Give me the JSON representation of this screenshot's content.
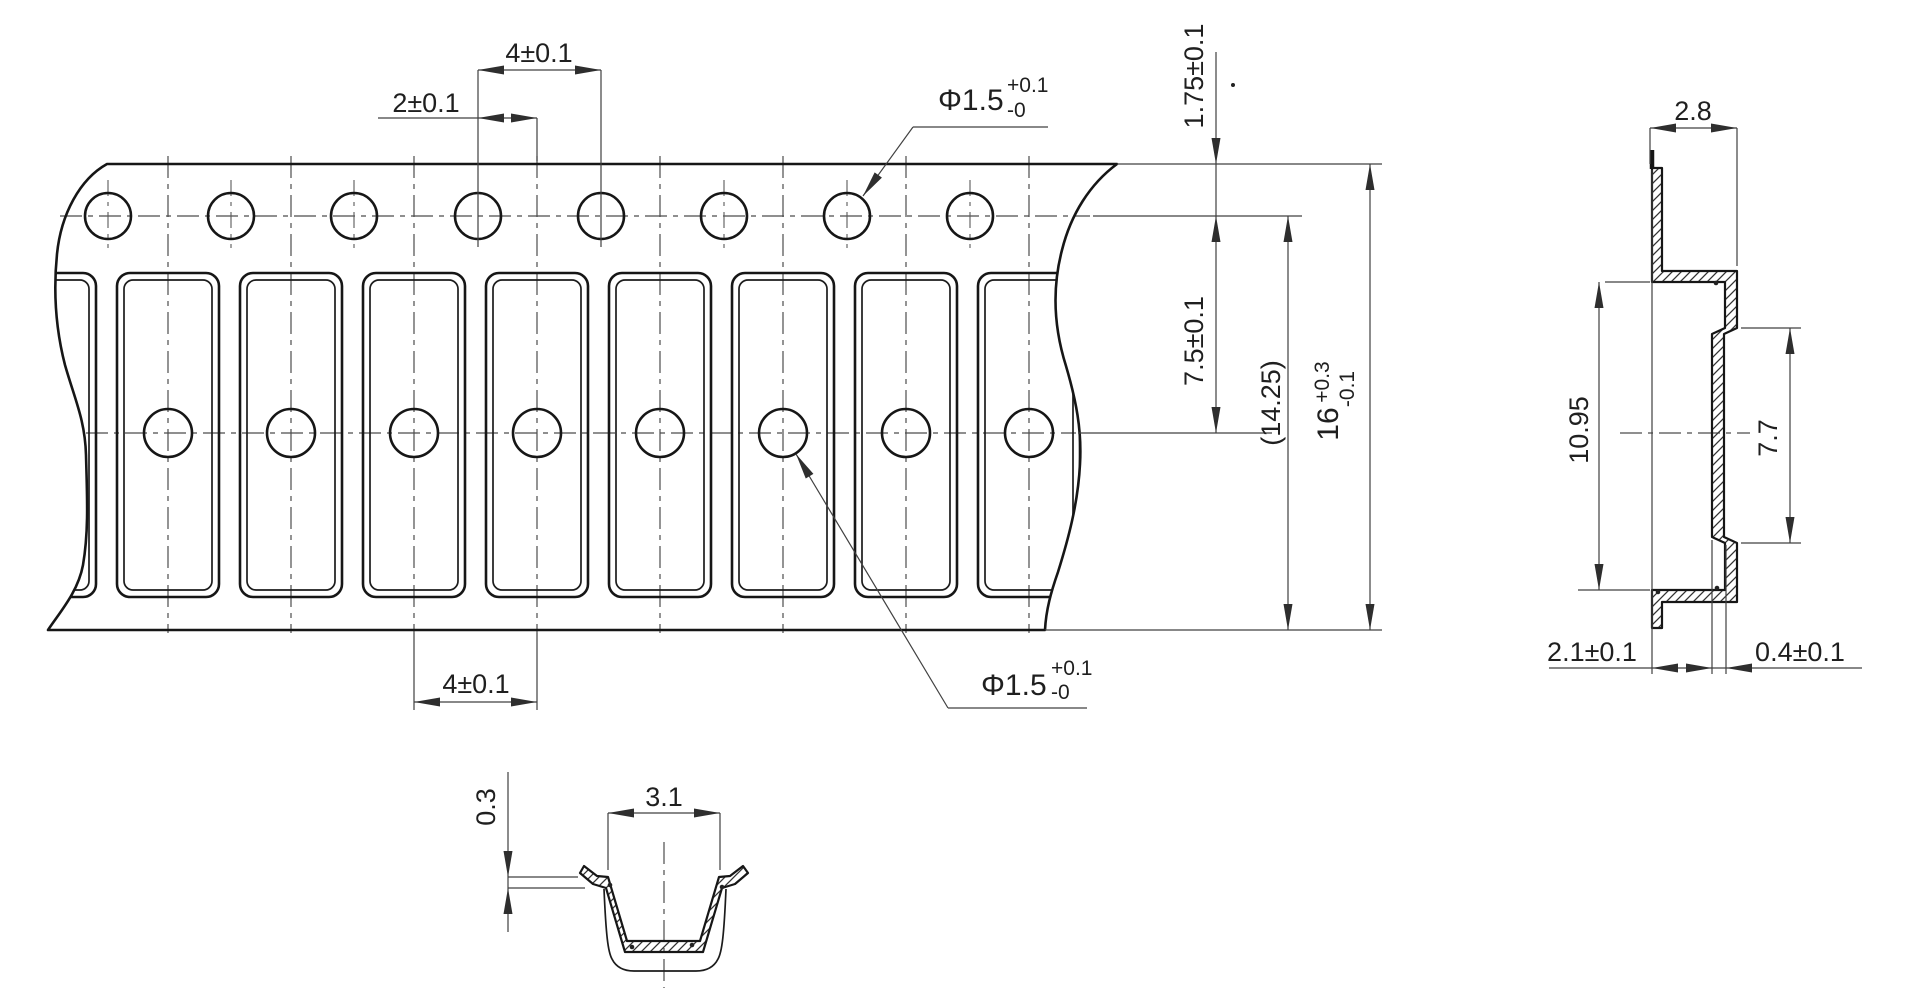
{
  "tape_view": {
    "pocket_pitch_top": "4±0.1",
    "sprocket_to_pocket_offset": "2±0.1",
    "sprocket_hole_dia": {
      "value": "Φ1.5",
      "tol_plus": "+0.1",
      "tol_minus": "-0"
    },
    "edge_to_sprocket_center": "1.75±0.1",
    "sprocket_to_pocket_center": "7.5±0.1",
    "ref_hole_to_edge": "(14.25)",
    "tape_width": {
      "value": "16",
      "tol_plus": "+0.3",
      "tol_minus": "-0.1"
    },
    "pocket_pitch_bottom": "4±0.1",
    "pocket_hole_dia": {
      "value": "Φ1.5",
      "tol_plus": "+0.1",
      "tol_minus": "-0"
    }
  },
  "side_section": {
    "pocket_depth": "2.8",
    "pocket_outer_length": "10.95",
    "pocket_inner_length": "7.7",
    "step_depth": "2.1±0.1",
    "step_offset": "0.4±0.1"
  },
  "end_section": {
    "flange_thickness": "0.3",
    "pocket_mouth_width": "3.1"
  }
}
